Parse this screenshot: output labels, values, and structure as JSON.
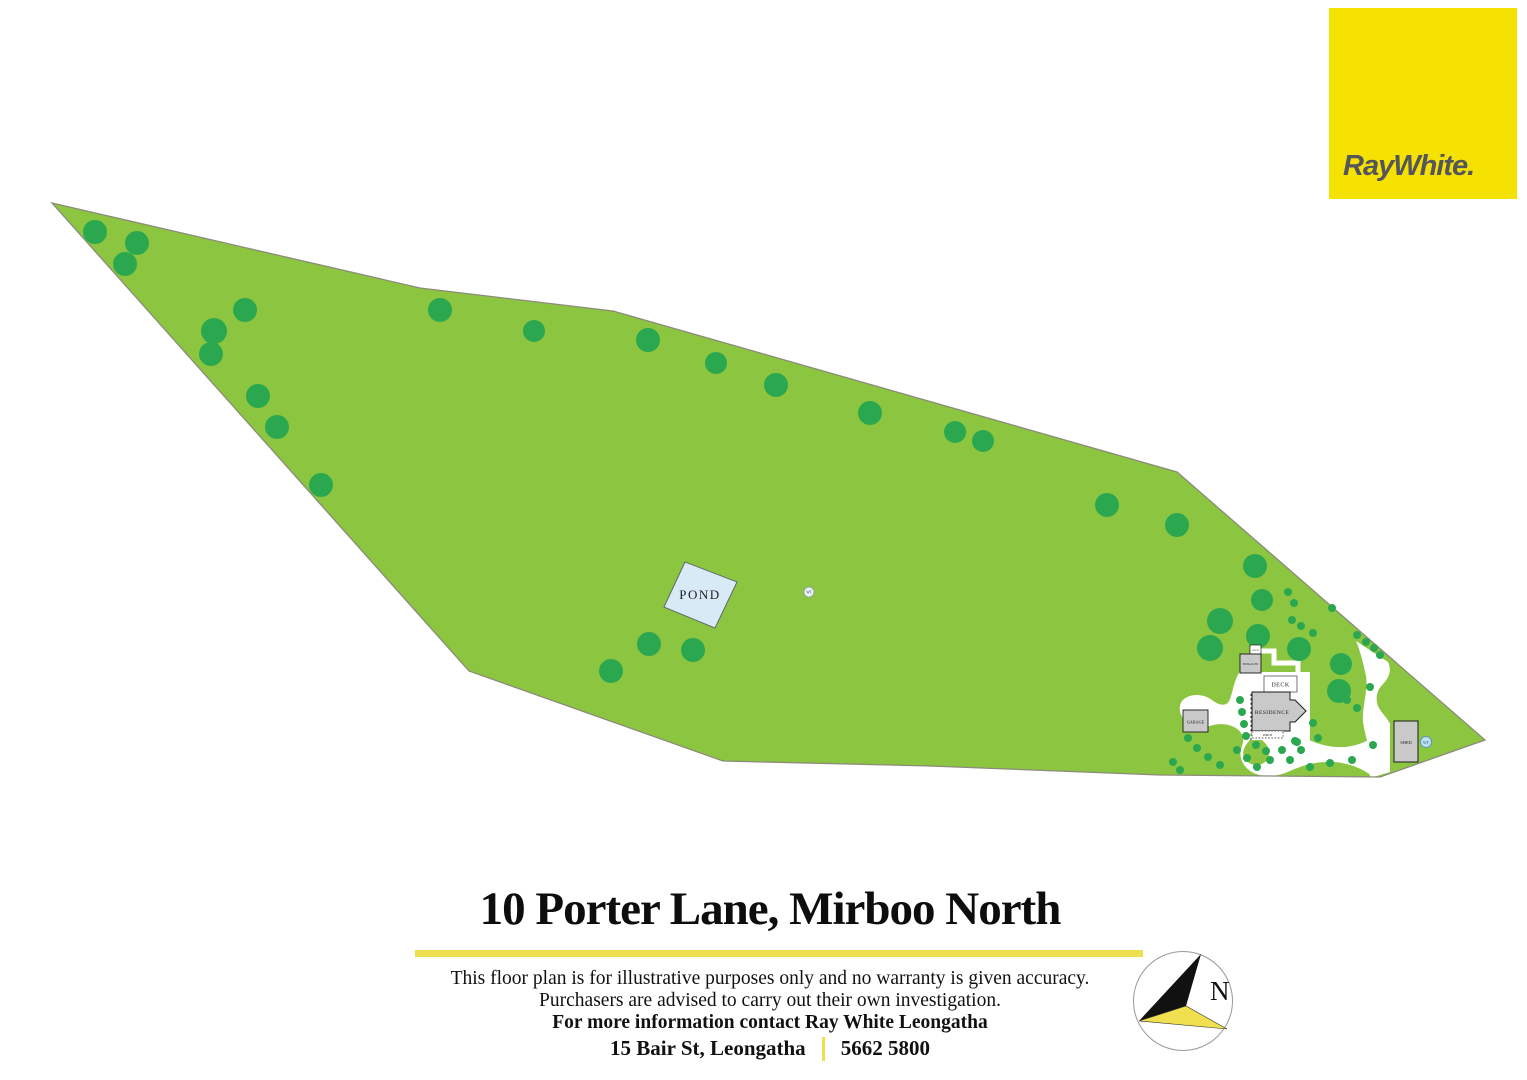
{
  "logo": {
    "brand": "RayWhite.",
    "background": "#F5E203",
    "text_color": "#54565B"
  },
  "footer": {
    "title": "10 Porter Lane, Mirboo North",
    "disclaimer_line1": "This floor plan is for illustrative purposes only and no warranty is given accuracy.",
    "disclaimer_line2": "Purchasers are advised to carry out their own investigation.",
    "contact_line": "For more information contact Ray White Leongatha",
    "address": "15 Bair St, Leongatha",
    "phone": "5662 5800",
    "accent_color": "#EDE04F"
  },
  "compass": {
    "north_label": "N"
  },
  "site_plan": {
    "labels": {
      "pond": "POND",
      "water_tank_field": "WT",
      "water_tank_shed": "WT",
      "garage": "GARAGE",
      "deck": "DECK",
      "bungalow": "BUNGALOW",
      "bungalow_deck": "DECK",
      "residence": "RESIDENCE",
      "porch": "PORCH",
      "shed": "SHED"
    },
    "colors": {
      "land": "#8CC540",
      "tree": "#2BA84F",
      "boundary": "#8B8B7A",
      "pond_fill": "#D9EAF7",
      "pond_stroke": "#55606B",
      "building_fill": "#C9C9C9",
      "building_stroke": "#1a1a1a",
      "tank_fill": "#BFE0F2",
      "tank_stroke": "#4C8FBF",
      "compass_yellow": "#F0DF4E"
    },
    "boundary_points": "52,203 420,288 613,311 1177,472 1485,740 1380,777 1160,775 930,766 723,761 469,671",
    "trees": [
      [
        95,
        232,
        12
      ],
      [
        137,
        243,
        12
      ],
      [
        125,
        264,
        12
      ],
      [
        245,
        310,
        12
      ],
      [
        214,
        331,
        13
      ],
      [
        211,
        354,
        12
      ],
      [
        258,
        396,
        12
      ],
      [
        277,
        427,
        12
      ],
      [
        321,
        485,
        12
      ],
      [
        440,
        310,
        12
      ],
      [
        534,
        331,
        11
      ],
      [
        648,
        340,
        12
      ],
      [
        716,
        363,
        11
      ],
      [
        776,
        385,
        12
      ],
      [
        870,
        413,
        12
      ],
      [
        955,
        432,
        11
      ],
      [
        983,
        441,
        11
      ],
      [
        1107,
        505,
        12
      ],
      [
        1177,
        525,
        12
      ],
      [
        1255,
        566,
        12
      ],
      [
        1262,
        600,
        11
      ],
      [
        1220,
        621,
        13
      ],
      [
        1258,
        636,
        12
      ],
      [
        1210,
        648,
        13
      ],
      [
        1299,
        649,
        12
      ],
      [
        1341,
        664,
        11
      ],
      [
        1339,
        691,
        12
      ],
      [
        649,
        644,
        12
      ],
      [
        693,
        650,
        12
      ],
      [
        611,
        671,
        12
      ]
    ],
    "shrubs": [
      [
        1288,
        592
      ],
      [
        1294,
        603
      ],
      [
        1332,
        608
      ],
      [
        1292,
        620
      ],
      [
        1301,
        626
      ],
      [
        1313,
        633
      ],
      [
        1357,
        635
      ],
      [
        1366,
        642
      ],
      [
        1374,
        648
      ],
      [
        1380,
        655
      ],
      [
        1370,
        687
      ],
      [
        1347,
        700
      ],
      [
        1357,
        708
      ],
      [
        1313,
        723
      ],
      [
        1318,
        738
      ],
      [
        1297,
        742
      ],
      [
        1282,
        750
      ],
      [
        1270,
        760
      ],
      [
        1257,
        767
      ],
      [
        1247,
        758
      ],
      [
        1237,
        750
      ],
      [
        1188,
        738
      ],
      [
        1197,
        748
      ],
      [
        1208,
        757
      ],
      [
        1220,
        765
      ],
      [
        1290,
        760
      ],
      [
        1310,
        767
      ],
      [
        1330,
        763
      ],
      [
        1352,
        760
      ],
      [
        1373,
        745
      ],
      [
        1240,
        700
      ],
      [
        1242,
        712
      ],
      [
        1244,
        724
      ],
      [
        1246,
        736
      ],
      [
        1256,
        745
      ],
      [
        1266,
        751
      ],
      [
        1295,
        741
      ],
      [
        1301,
        750
      ],
      [
        1173,
        762
      ],
      [
        1180,
        770
      ]
    ]
  }
}
